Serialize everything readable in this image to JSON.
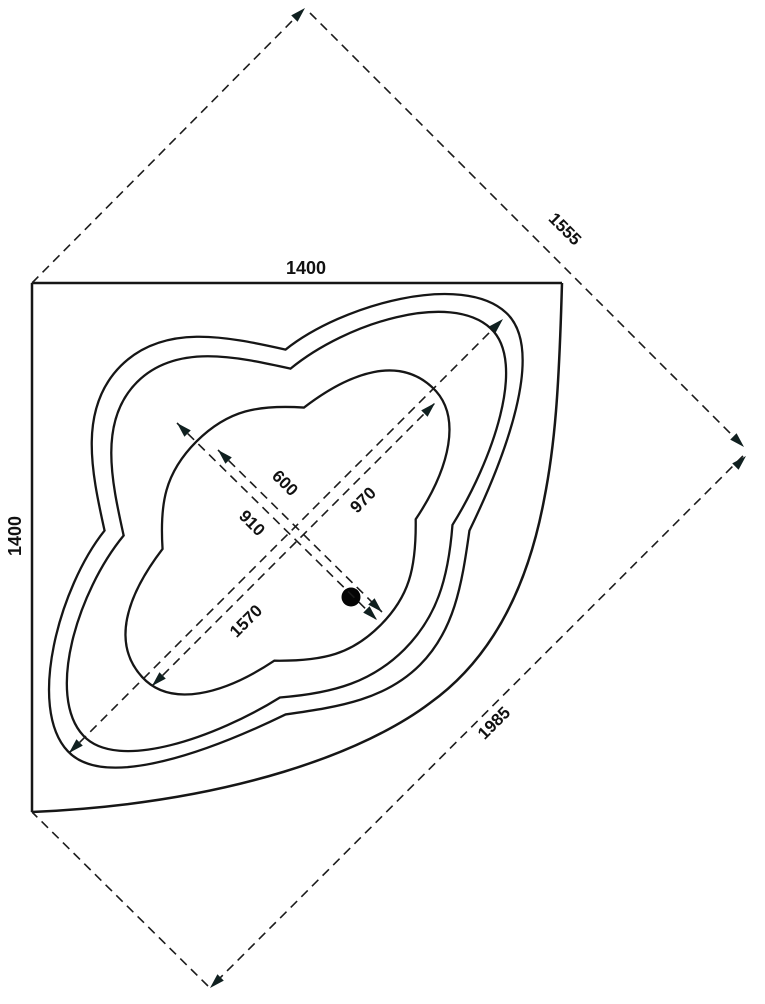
{
  "drawing": {
    "kind": "corner-bathtub-plan",
    "colors": {
      "line": "#161616",
      "background": "#ffffff"
    },
    "dimensions": {
      "wall_top": "1400",
      "wall_left": "1400",
      "diagonal_upper_right": "1555",
      "diagonal_front": "1985",
      "tub_long_axis": "1570",
      "basin_long_axis": "970",
      "rim_cross_axis": "910",
      "basin_cross_axis": "600"
    }
  }
}
